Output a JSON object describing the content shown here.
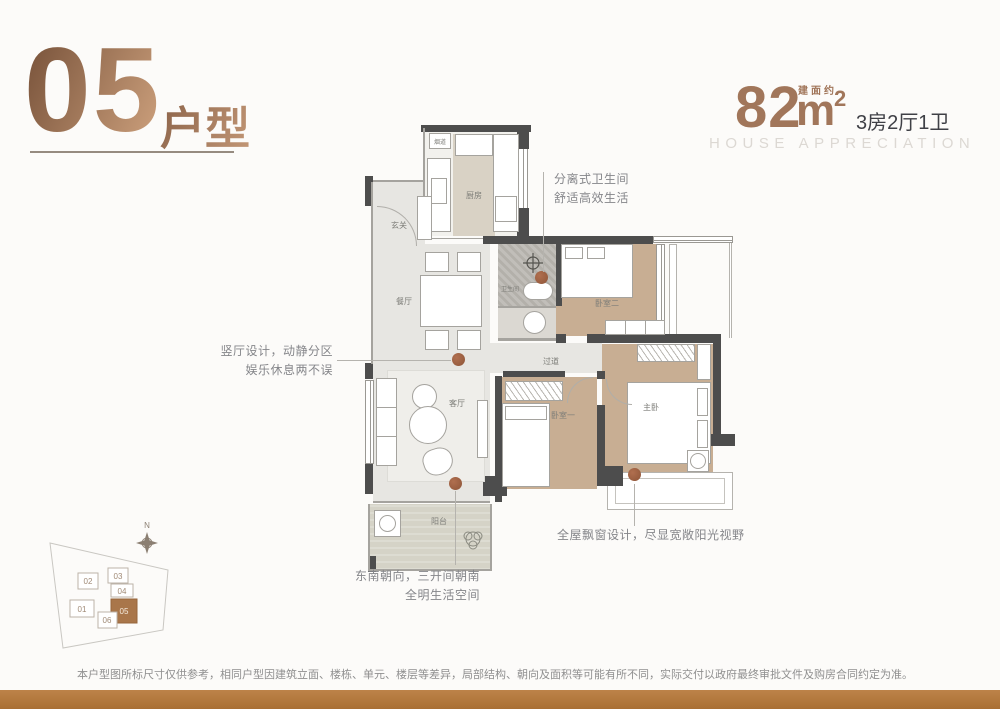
{
  "header": {
    "unit_number": "05",
    "unit_label": "户型"
  },
  "area": {
    "value": "82",
    "unit": "m",
    "sup": "2",
    "approx_label": "建面约",
    "layout": "3房2厅1卫",
    "subtitle": "HOUSE APPRECIATION"
  },
  "plan": {
    "rooms": {
      "entry": "玄关",
      "flue": "烟道",
      "kitchen": "厨房",
      "dining": "餐厅",
      "bathroom": "卫生间",
      "bedroom2": "卧室二",
      "corridor": "过道",
      "living": "客厅",
      "bedroom1": "卧室一",
      "master": "主卧",
      "balcony": "阳台"
    }
  },
  "callouts": {
    "bathroom": {
      "line1": "分离式卫生间",
      "line2": "舒适高效生活"
    },
    "hall": {
      "line1": "竖厅设计，动静分区",
      "line2": "娱乐休息两不误"
    },
    "orientation": {
      "line1": "东南朝向，三开间朝南",
      "line2": "全明生活空间"
    },
    "baywindow": {
      "line1": "全屋飘窗设计，尽显宽敞阳光视野"
    }
  },
  "siteplan": {
    "compass": "N",
    "units": [
      "01",
      "02",
      "03",
      "04",
      "05",
      "06"
    ],
    "highlighted": "05"
  },
  "disclaimer": "本户型图所标尺寸仅供参考，相同户型因建筑立面、楼栋、单元、楼层等差异，局部结构、朝向及面积等可能有所不同，实际交付以政府最终审批文件及购房合同约定为准。",
  "colors": {
    "accent_bronze": "#a1765a",
    "wall": "#4d4d4d",
    "bedroom_floor": "#c8ae93",
    "marker": "#9c5f45",
    "footer_bar": "#b2783e"
  }
}
